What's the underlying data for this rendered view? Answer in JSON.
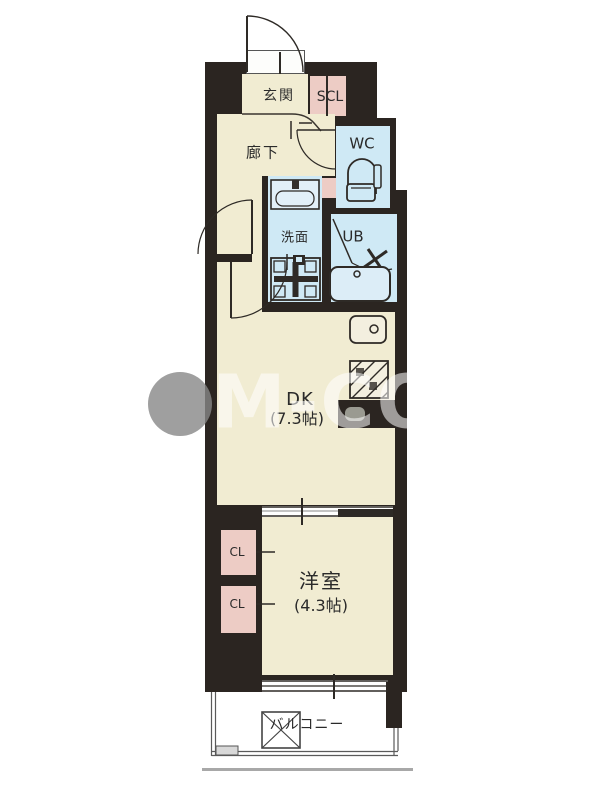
{
  "rooms": {
    "genkan": {
      "label": "玄関"
    },
    "scl": {
      "label": "SCL"
    },
    "hallway": {
      "label": "廊下"
    },
    "wc": {
      "label": "WC"
    },
    "senmen": {
      "label": "洗面"
    },
    "ub": {
      "label": "UB"
    },
    "dk": {
      "label": "DK",
      "size": "(7.3帖)"
    },
    "cl1": {
      "label": "CL"
    },
    "cl2": {
      "label": "CL"
    },
    "western": {
      "label": "洋室",
      "size": "(4.3帖)"
    },
    "balcony": {
      "label": "バルコニー"
    }
  },
  "watermark": {
    "text": "M-CO"
  },
  "colors": {
    "wall": "#2b2521",
    "floor": "#f1ecd2",
    "wet_area": "#cfe9f5",
    "closet": "#edccc5",
    "balcony_line": "#5a5a5a",
    "watermark_gray": "#878787"
  }
}
